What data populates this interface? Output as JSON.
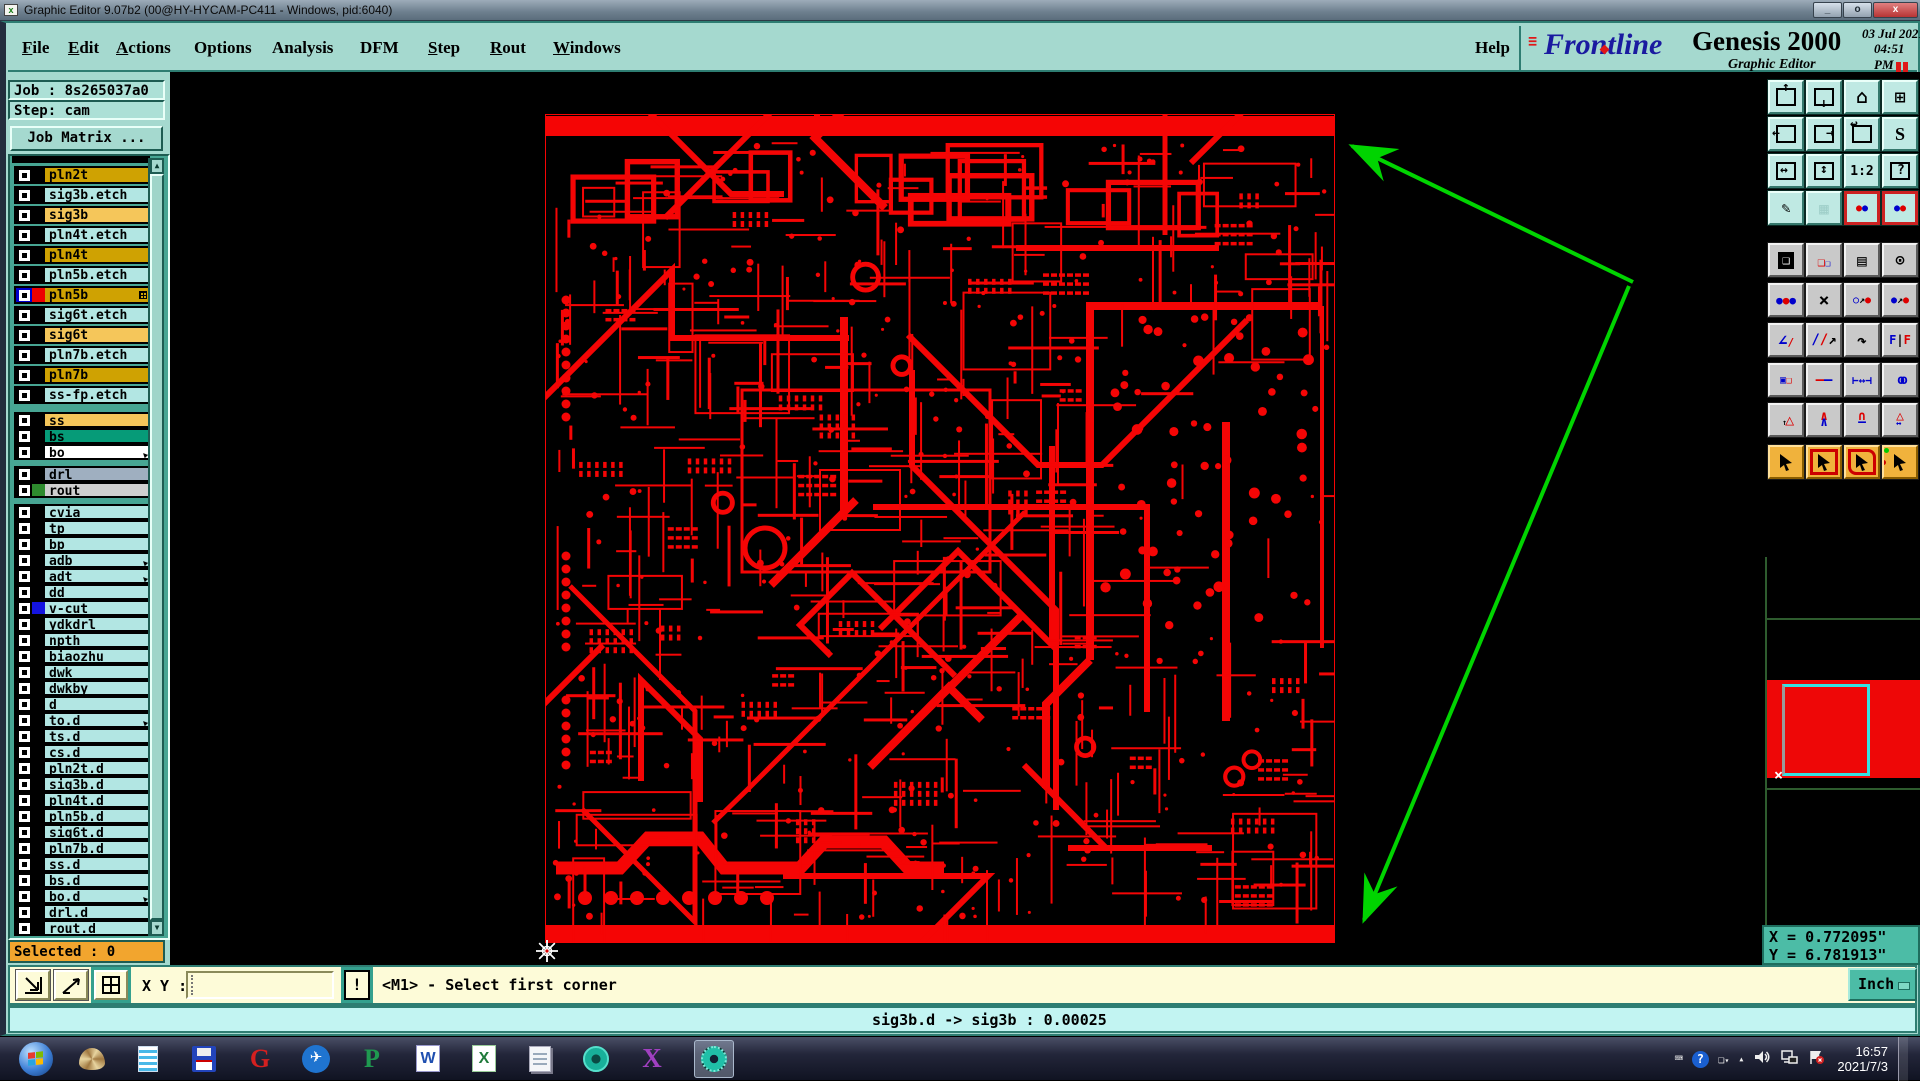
{
  "window": {
    "title": "Graphic Editor 9.07b2 (00@HY-HYCAM-PC411 - Windows, pid:6040)",
    "minimize": "_",
    "maximize": "o",
    "close": "x",
    "icon_glyph": "x"
  },
  "menu": {
    "items": [
      {
        "label": "File",
        "u": 0
      },
      {
        "label": "Edit",
        "u": 0
      },
      {
        "label": "Actions",
        "u": 0
      },
      {
        "label": "Options",
        "u": -1
      },
      {
        "label": "Analysis",
        "u": -1
      },
      {
        "label": "DFM",
        "u": -1
      },
      {
        "label": "Step",
        "u": 0
      },
      {
        "label": "Rout",
        "u": 0
      },
      {
        "label": "Windows",
        "u": 0
      }
    ],
    "help": "Help"
  },
  "brand": {
    "stripes": "=\n=\n=",
    "logo": "Frontline",
    "product": "Genesis 2000",
    "date": "03 Jul 2021",
    "time": "04:51 PM",
    "tagline": "Graphic Editor"
  },
  "job": {
    "job_line": "Job : 8s265037a0",
    "step_line": "Step: cam",
    "matrix_button": "Job Matrix ...",
    "selected": "Selected : 0"
  },
  "layers": [
    {
      "label": "pln2t",
      "bg": "gold",
      "sec": 1
    },
    {
      "label": "sig3b.etch",
      "bg": "cyanrow",
      "sec": 1
    },
    {
      "label": "sig3b",
      "bg": "amber",
      "sec": 1
    },
    {
      "label": "pln4t.etch",
      "bg": "cyanrow",
      "sec": 1
    },
    {
      "label": "pln4t",
      "bg": "gold",
      "sec": 1
    },
    {
      "label": "pln5b.etch",
      "bg": "cyanrow",
      "sec": 1
    },
    {
      "label": "pln5b",
      "bg": "gold",
      "sec": 1,
      "swatch": "red",
      "cb": "active",
      "mark": "grid"
    },
    {
      "label": "sig6t.etch",
      "bg": "cyanrow",
      "sec": 1
    },
    {
      "label": "sig6t",
      "bg": "amber",
      "sec": 1
    },
    {
      "label": "pln7b.etch",
      "bg": "cyanrow",
      "sec": 1
    },
    {
      "label": "pln7b",
      "bg": "gold",
      "sec": 1
    },
    {
      "label": "ss-fp.etch",
      "bg": "cyanrow",
      "sec": 1
    },
    {
      "label": "ss",
      "bg": "amber",
      "sec": 2
    },
    {
      "label": "bs",
      "bg": "tealrow",
      "sec": 2
    },
    {
      "label": "bo",
      "bg": "white",
      "sec": 2,
      "mark": "arrow"
    },
    {
      "label": "drl",
      "bg": "bluegray",
      "sec": 3
    },
    {
      "label": "rout",
      "bg": "lightgray",
      "sec": 3,
      "swatch": "green"
    },
    {
      "label": "cvia",
      "bg": "cyanrow",
      "sec": 4
    },
    {
      "label": "tp",
      "bg": "cyanrow",
      "sec": 4
    },
    {
      "label": "bp",
      "bg": "cyanrow",
      "sec": 4
    },
    {
      "label": "adb",
      "bg": "cyanrow",
      "sec": 4,
      "mark": "arrow"
    },
    {
      "label": "adt",
      "bg": "cyanrow",
      "sec": 4,
      "mark": "arrow"
    },
    {
      "label": "dd",
      "bg": "cyanrow",
      "sec": 4
    },
    {
      "label": "v-cut",
      "bg": "cyanrow",
      "sec": 4,
      "swatch": "blue"
    },
    {
      "label": "ydkdrl",
      "bg": "cyanrow",
      "sec": 4
    },
    {
      "label": "npth",
      "bg": "cyanrow",
      "sec": 4
    },
    {
      "label": "biaozhu",
      "bg": "cyanrow",
      "sec": 4
    },
    {
      "label": "dwk",
      "bg": "cyanrow",
      "sec": 4
    },
    {
      "label": "dwkby",
      "bg": "cyanrow",
      "sec": 4
    },
    {
      "label": "d",
      "bg": "cyanrow",
      "sec": 4
    },
    {
      "label": "to.d",
      "bg": "cyanrow",
      "sec": 4,
      "mark": "arrow"
    },
    {
      "label": "ts.d",
      "bg": "cyanrow",
      "sec": 4
    },
    {
      "label": "cs.d",
      "bg": "cyanrow",
      "sec": 4
    },
    {
      "label": "pln2t.d",
      "bg": "cyanrow",
      "sec": 4
    },
    {
      "label": "sig3b.d",
      "bg": "cyanrow",
      "sec": 4
    },
    {
      "label": "pln4t.d",
      "bg": "cyanrow",
      "sec": 4
    },
    {
      "label": "pln5b.d",
      "bg": "cyanrow",
      "sec": 4
    },
    {
      "label": "sig6t.d",
      "bg": "cyanrow",
      "sec": 4
    },
    {
      "label": "pln7b.d",
      "bg": "cyanrow",
      "sec": 4
    },
    {
      "label": "ss.d",
      "bg": "cyanrow",
      "sec": 4
    },
    {
      "label": "bs.d",
      "bg": "cyanrow",
      "sec": 4
    },
    {
      "label": "bo.d",
      "bg": "cyanrow",
      "sec": 4,
      "mark": "arrow"
    },
    {
      "label": "drl.d",
      "bg": "cyanrow",
      "sec": 4
    },
    {
      "label": "rout.d",
      "bg": "cyanrow",
      "sec": 4
    }
  ],
  "toolbar": {
    "sectionA": [
      "zoom-in",
      "zoom-out",
      "home-view",
      "views-xy",
      "pan-left",
      "pan-right",
      "previous-view",
      "serpentine-view",
      "zoom-out-2x",
      "zoom-in-2x",
      "zoom-1-2",
      "help-query",
      "setup-editor",
      "grid-toggle",
      "display-nets-1",
      "display-nets-2"
    ],
    "zoom_ratio_label": "1:2",
    "sectionB": [
      "copy-other-win",
      "move-other-win",
      "measure",
      "select-feature",
      "net-highlight",
      "delete",
      "copy-to-layer",
      "move-to-layer",
      "arc-mode",
      "line-mode",
      "rotate",
      "mirror",
      "resize",
      "stretch",
      "width-measure",
      "touching",
      "triangle-up",
      "triangle-chevron",
      "triangle-arch",
      "triangle-span"
    ],
    "mirror_label": "F|F",
    "sectionC": [
      "select-pointer",
      "select-rectangle",
      "select-polygon",
      "select-net-path"
    ]
  },
  "bottom": {
    "xy_label": "X Y :",
    "input_value": "",
    "bang": "!",
    "prompt": "<M1> - Select first corner",
    "unit": "Inch"
  },
  "readout": {
    "x": "X = 0.772095\"",
    "y": "Y = 6.781913\""
  },
  "message": "sig3b.d -> sig3b : 0.00025",
  "taskbar": {
    "apps": [
      "start",
      "shell-app",
      "list-app",
      "floppy-app",
      "g-app",
      "bird-app",
      "p-app",
      "word",
      "excel",
      "notepad",
      "cam-tool",
      "x-server",
      "genesis-active"
    ],
    "tray": [
      "keyboard",
      "help-bubble",
      "window-restore",
      "hidden-icons",
      "volume",
      "network",
      "action-center"
    ],
    "time": "16:57",
    "date": "2021/7/3"
  },
  "colors": {
    "gold": "#cfa202",
    "amber": "#f5c65a",
    "cyanrow": "#b2e6e3",
    "tealrow": "#069b78",
    "white": "#ffffff",
    "bluegray": "#9fafc0",
    "lightgray": "#cfcfcf",
    "swatch_red": "#ee0000",
    "swatch_green": "#2e8b2e",
    "swatch_blue": "#1414e0",
    "pcb_red": "#f50505",
    "arrow_green": "#00d400",
    "selected_bg": "#f2a52e"
  },
  "canvas": {
    "board": {
      "x": 545,
      "y": 114,
      "w": 790,
      "h": 829
    },
    "arrow_vertex": [
      1633,
      282
    ],
    "arrow_head_top": [
      1352,
      146
    ],
    "arrow_head_bottom": [
      1364,
      920
    ],
    "cursor": [
      547,
      951
    ]
  }
}
